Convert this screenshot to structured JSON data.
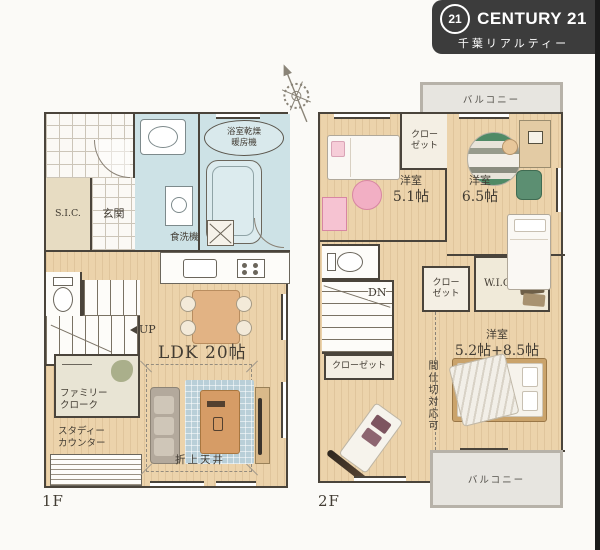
{
  "brand": {
    "mark": "21",
    "name": "CENTURY 21",
    "subtitle": "千葉リアルティー",
    "badge_color": "#3c3c3c"
  },
  "palette": {
    "floor_wood": "#ecd3ab",
    "wet_area_blue": "#cde2e6",
    "wall": "#4a443b",
    "balcony_gray": "#e7e5e0"
  },
  "floor1": {
    "tag": "1F",
    "sic": "S.I.C.",
    "genkan": "玄関",
    "bath_unit_line1": "浴室乾燥",
    "bath_unit_line2": "暖房機",
    "dishwasher": "食洗機",
    "ldk": "LDK 20帖",
    "up": "UP",
    "family_cloak_line1": "ファミリー",
    "family_cloak_line2": "クローク",
    "study_line1": "スタディー",
    "study_line2": "カウンター",
    "coffered_ceiling": "折上天井"
  },
  "floor2": {
    "tag": "2F",
    "balcony_top": "バルコニー",
    "balcony_bottom": "バルコニー",
    "closet_a_line1": "クロー",
    "closet_a_line2": "ゼット",
    "closet_b_line1": "クロー",
    "closet_b_line2": "ゼット",
    "closet_c": "クローゼット",
    "room_a_name": "洋室",
    "room_a_size": "5.1帖",
    "room_b_name": "洋室",
    "room_b_size": "6.5帖",
    "room_c_name": "洋室",
    "room_c_size": "5.2帖+8.5帖",
    "wic": "W.I.C.",
    "dn": "DN",
    "partition_note": "間仕切対応可"
  }
}
